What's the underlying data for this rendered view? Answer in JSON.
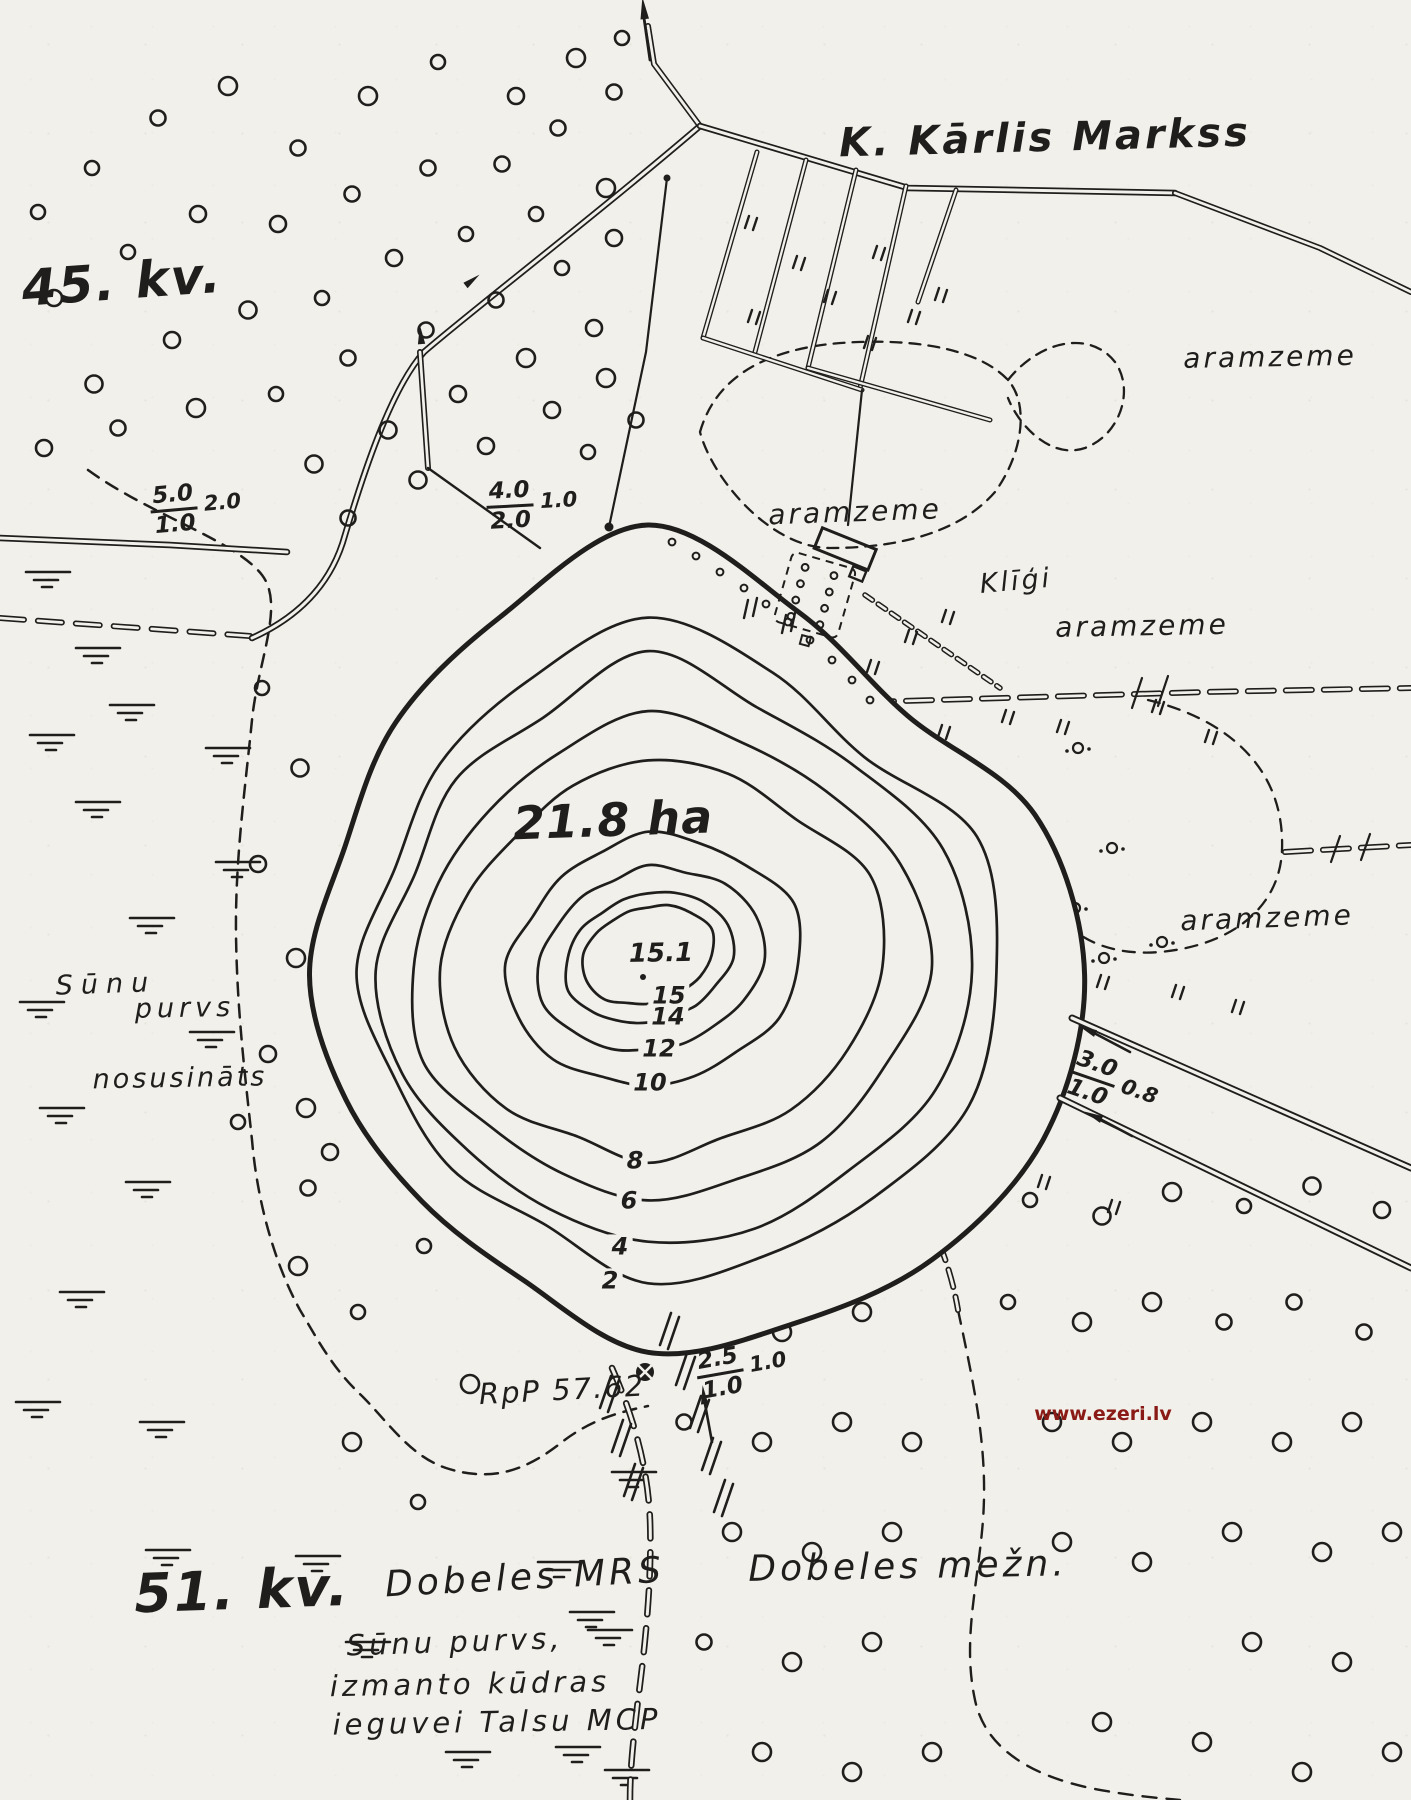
{
  "colors": {
    "ink": "#1f1e1c",
    "paper": "#f2f0ea",
    "watermark": "#8a1a15"
  },
  "map": {
    "title": "K. Kārlis Markss",
    "quarter_top": "45. kv.",
    "quarter_bottom": "51. kv.",
    "area": "21.8 ha",
    "max_depth": "15.1",
    "aramzeme": "aramzeme",
    "farm": "Klīģi",
    "benchmark": "RpP 57.62",
    "watermark": "www.ezeri.lv",
    "bog": {
      "line1": "Sūnu",
      "line2": "purvs",
      "line3": "nosusināts"
    },
    "forestry_station": "Dobeles MRS",
    "forestry_district": "Dobeles mežn.",
    "note": {
      "line1": "Sūnu purvs,",
      "line2": "izmanto kūdras",
      "line3": "ieguvei Talsu MCP"
    },
    "depth_labels": [
      "15",
      "14",
      "12",
      "10",
      "8",
      "6",
      "4",
      "2"
    ],
    "ditch_specs": [
      {
        "depth": "5.0",
        "width": "1.0",
        "flow": "2.0"
      },
      {
        "depth": "4.0",
        "width": "2.0",
        "flow": "1.0"
      },
      {
        "depth": "3.0",
        "width": "1.0",
        "flow": "0.8"
      },
      {
        "depth": "2.5",
        "width": "1.0",
        "flow": "1.0"
      }
    ]
  }
}
